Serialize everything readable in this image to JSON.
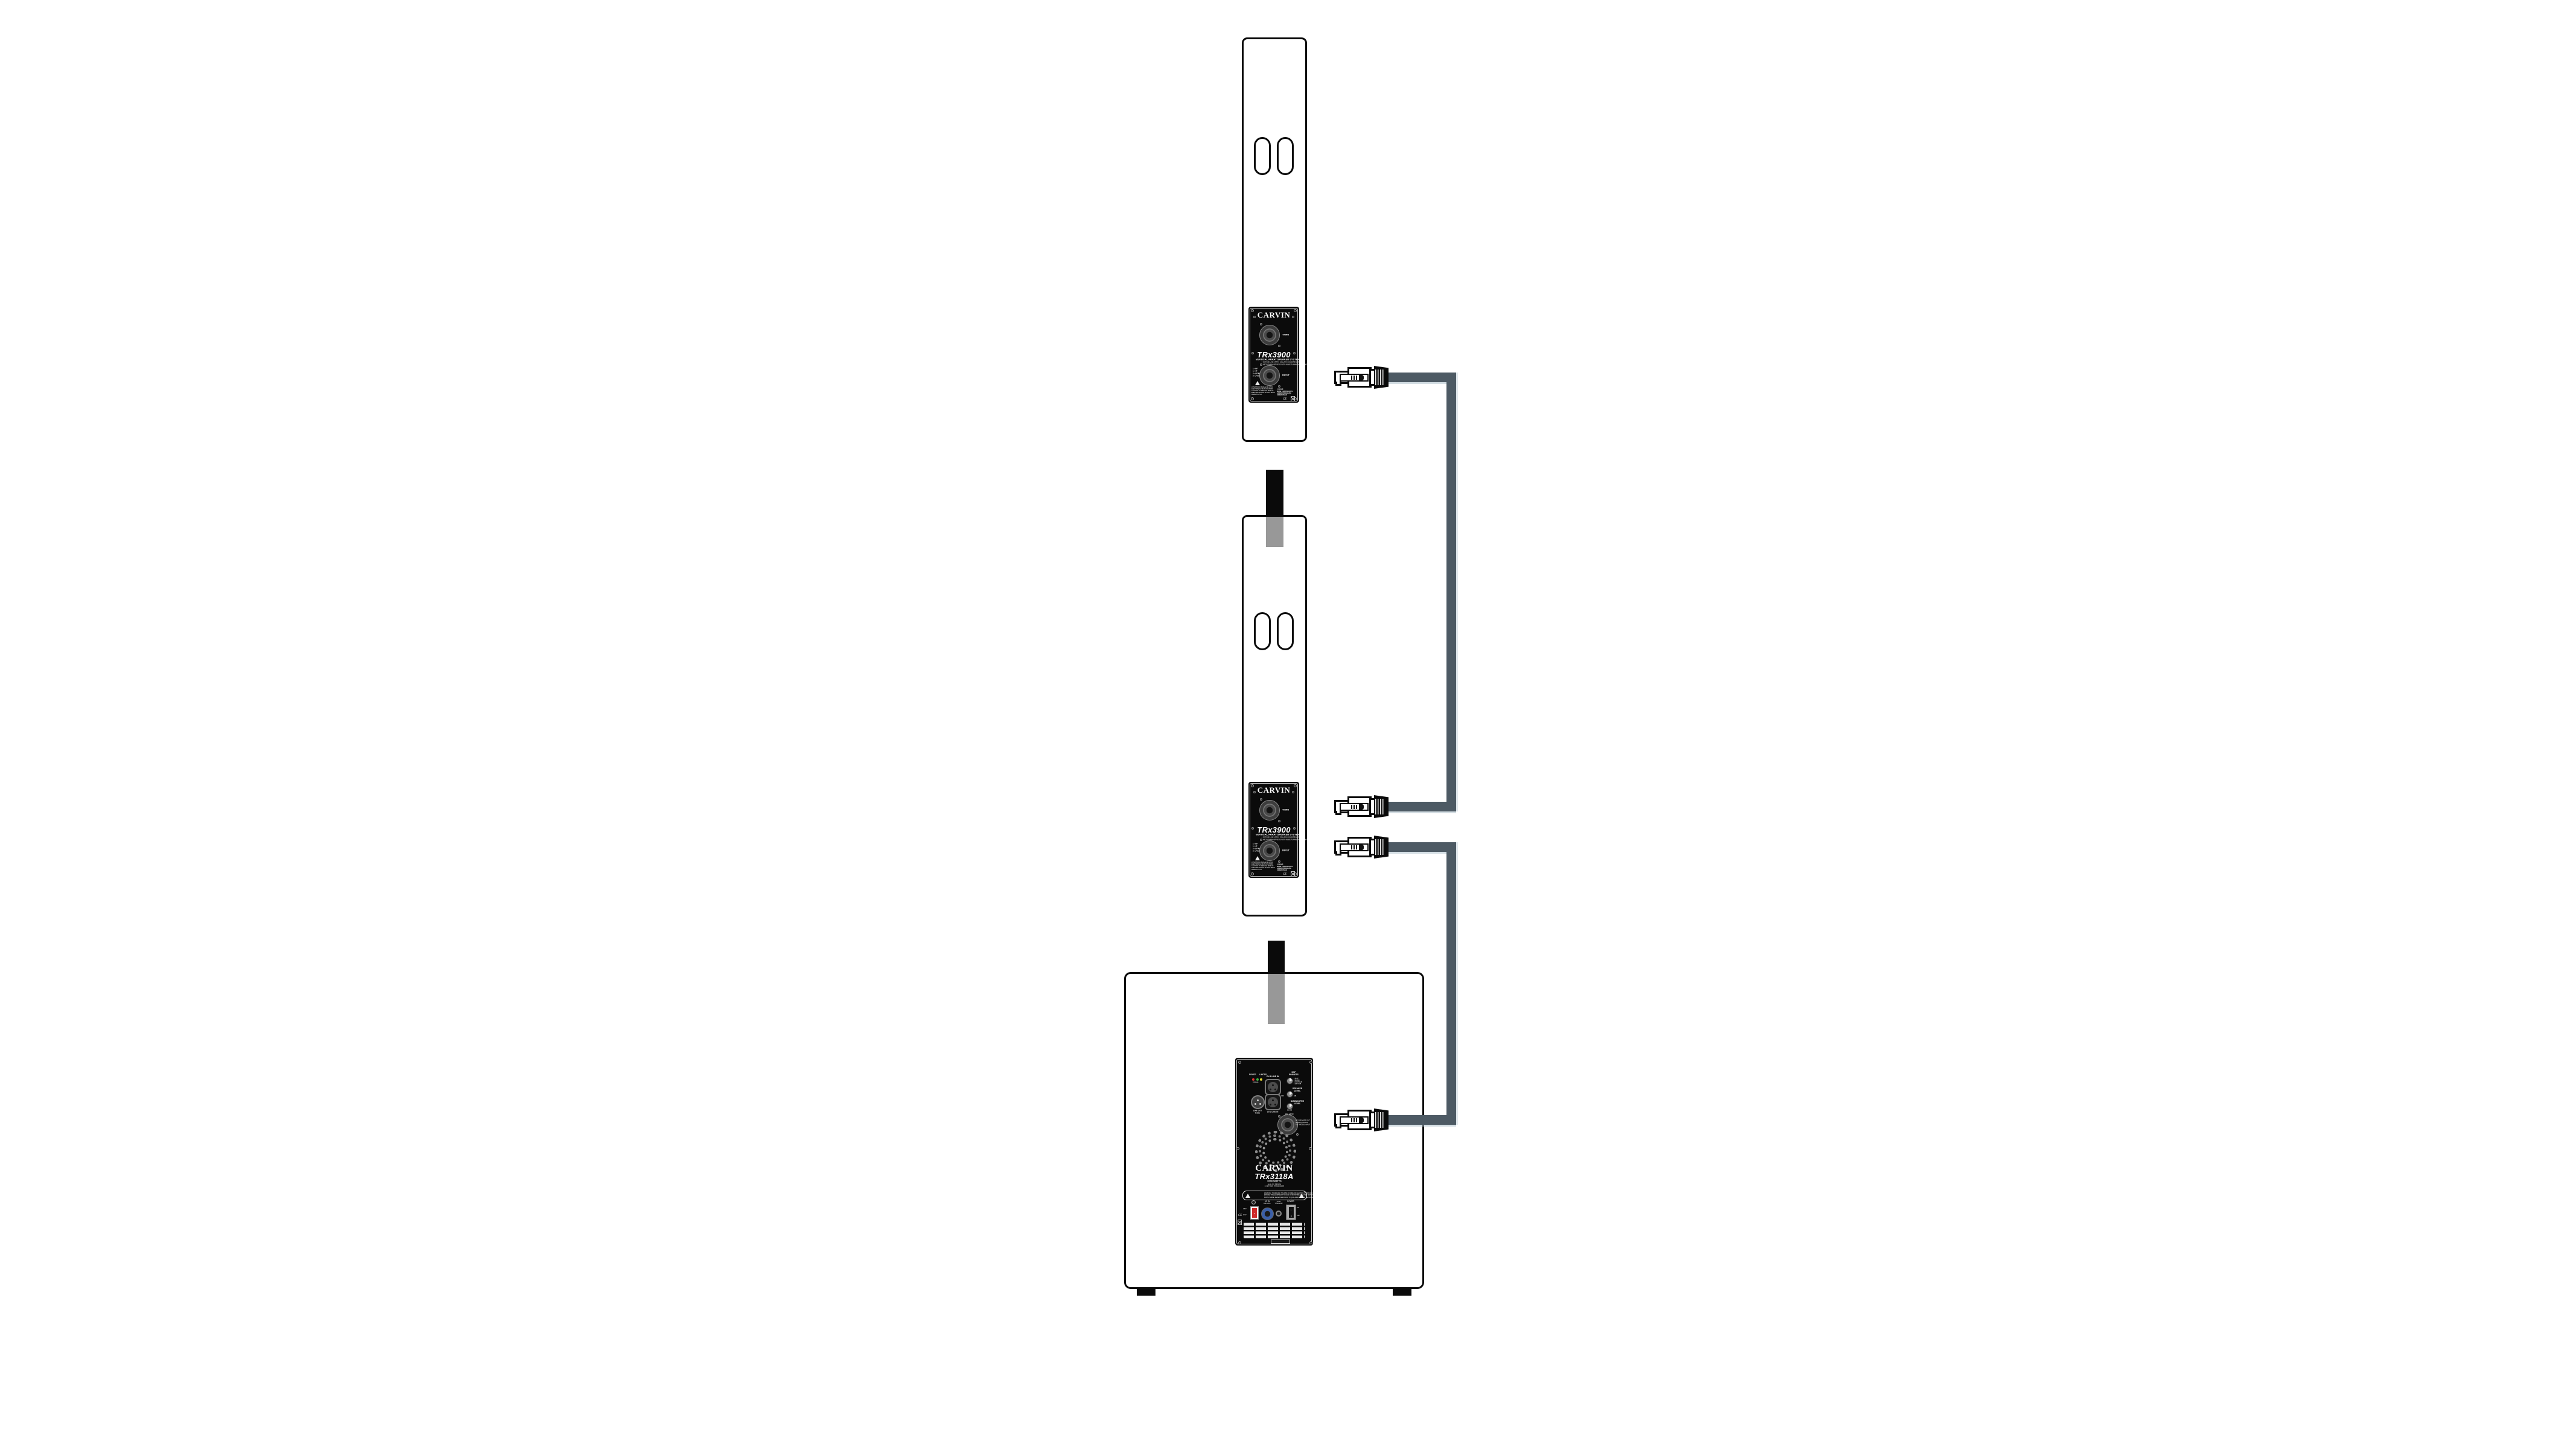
{
  "colors": {
    "cable": "#4d5a64",
    "pole_gray": "#989898",
    "outline": "#0a0a0a",
    "panel_bg": "#0b0b0b",
    "led_red": "#e03434",
    "led_green": "#3db53d",
    "led_yellow": "#e2d432",
    "ac_blue": "#3b5fa8",
    "voltage_red": "#cf2a2a"
  },
  "trx_panel": {
    "brand": "CARVIN",
    "thru": "THRU",
    "input": "INPUT",
    "model": "TRx3900",
    "subtitle": "VERTICAL ARRAY SPEAKER SYSTEM",
    "desc1": "4 OCTAVE LINE ARRAY COLUMN LOUDSPEAKER",
    "desc2": "8 NEODYMIUM DRIVERS WITH WAVE PLANAR HF · 800W RMS",
    "pin1": "1+ HF",
    "pin2": "1-  HF",
    "pin3": "2+ LF/MID",
    "pin4": "2-  LF/MID",
    "warn1": "ATTENTION: RISQUE DE CHOC",
    "warn2": "ELECTRIQUE. NE PAS OUVRIR.",
    "warn3": "CAUTION: TO REDUCE RISK OF",
    "warn4": "ELECTRIC SHOCK DO NOT OPEN.",
    "warn5": "MADE IN U.S.A.",
    "spec1": "4 OHMS",
    "spec2": "600W CONTINUOUS",
    "spec3": "1200W PROGRAM",
    "spec4": "2400W PEAK",
    "ce": "CE"
  },
  "sub_panel": {
    "brand": "CARVIN",
    "model": "TRx3118A",
    "watts": "2000 WATTS",
    "tag1": "ANALOG DESIGN",
    "tag2": "24 BIT DSP PROCESSOR",
    "power": "POWER",
    "limiter": "LIMITER",
    "signal": "SIGNAL",
    "ch1": "CH 1 LINE IN",
    "dsp1": "DSP",
    "dsp2": "PRESETS",
    "preset1": "1 FLAT",
    "preset2": "2 MUSIC",
    "preset3": "3 CONTOUR",
    "preset4": "4 EXT SUB",
    "spk1": "SPEAKER",
    "spk2": "LEVEL",
    "off": "OFF",
    "gain": "0dB",
    "lo1": "LINE OUT",
    "lo2": "THRU",
    "ch2": "CH 2 LINE IN",
    "sub1": "SUBWOOFER",
    "sub2": "LEVEL",
    "pol_deg": "0 | 180",
    "polarity": "POLARITY",
    "out1": "HF SPEAKER OUT",
    "out2": "400W @ 8Ω MIN",
    "out3": "TO TRx3900 INPUT",
    "w1": "WARNING: TO REDUCE THE RISK OF FIRE OR ELECTRIC SHOCK DO NOT",
    "w2": "EXPOSE THIS EQUIPMENT TO RAIN OR MOISTURE. NO USER SERVICEABLE",
    "w3": "PARTS INSIDE. REFER SERVICING TO QUALIFIED SERVICE PERSONNEL.",
    "volt_hi": "230V",
    "volt_lo": "115V",
    "volt_arrow": "▼",
    "ac1": "AC IN",
    "ac2": "100-120V~",
    "fuse1": "FUSE",
    "fuse2": "T15AL 250V",
    "psw": "POWER",
    "sw_on": "I",
    "sw_off": "O",
    "on": "ON",
    "off2": "OFF",
    "ce": "CE"
  }
}
